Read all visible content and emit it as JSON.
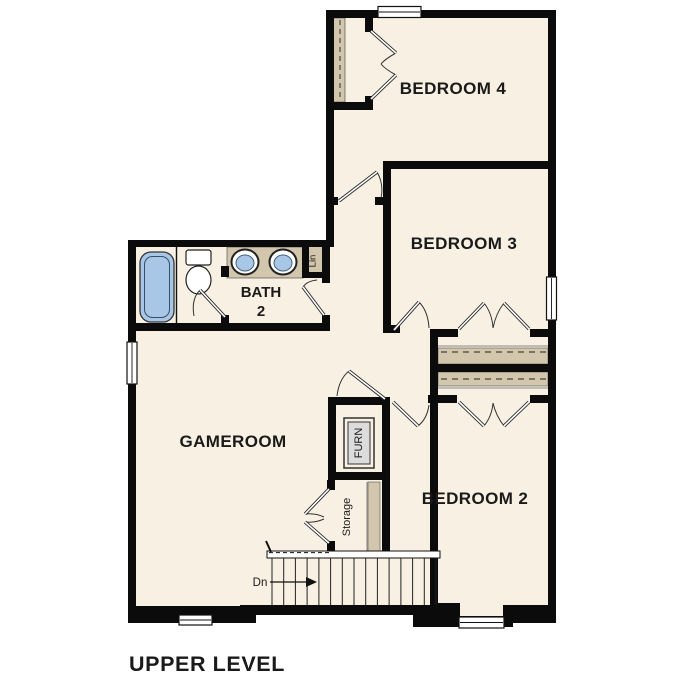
{
  "page": {
    "title": "UPPER LEVEL"
  },
  "colors": {
    "background": "#FFFFFF",
    "floor": "#F7F0E3",
    "wall": "#0B0B0B",
    "shelf_tan": "#D2C6AC",
    "fixture_blue": "#A8C7E6",
    "fixture_gray": "#DCDCDC",
    "label_text": "#1A1A1A"
  },
  "rooms": {
    "bedroom4": {
      "label": "BEDROOM 4"
    },
    "bedroom3": {
      "label": "BEDROOM 3"
    },
    "bedroom2": {
      "label": "BEDROOM 2"
    },
    "gameroom": {
      "label": "GAMEROOM"
    },
    "bath": {
      "label_line1": "BATH",
      "label_line2": "2"
    }
  },
  "closets": {
    "linen": {
      "label": "Lin"
    },
    "furnace": {
      "label": "FURN"
    },
    "storage": {
      "label": "Storage"
    }
  },
  "stairs": {
    "down_label": "Dn"
  }
}
